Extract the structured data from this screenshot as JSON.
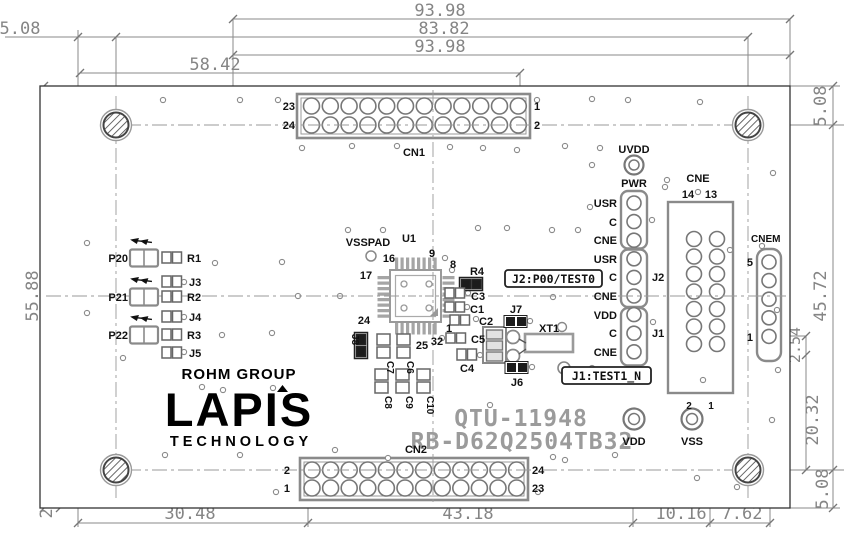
{
  "drawing": {
    "logo": {
      "rohm_group": "ROHM GROUP",
      "lapis": "LAPIS",
      "technology": "TECHNOLOGY"
    },
    "codes": {
      "line1": "QTU-11948",
      "line2": "RB-D62Q2504TB32"
    },
    "dims": {
      "top_outer": "93.98",
      "top_holes": "83.82",
      "top_inner": "93.98",
      "cn1_offset": "58.42",
      "hole_offset_left": "5.08",
      "board_height": "55.88",
      "pin_span_v": "50.8",
      "bottom_left_gap": "2.54",
      "b1": "30.48",
      "b2": "43.18",
      "b3": "10.16",
      "b4": "7.62",
      "r_top": "5.08",
      "r_span": "45.72",
      "r_pitch": "2.54",
      "r_mid": "20.32",
      "r_bot": "5.08"
    },
    "cn1": {
      "label": "CN1",
      "tl": "23",
      "bl": "24",
      "tr": "1",
      "br": "2"
    },
    "cn2": {
      "label": "CN2",
      "tl": "2",
      "bl": "1",
      "tr": "24",
      "br": "23"
    },
    "cne": {
      "label": "CNE",
      "t1": "14",
      "t2": "13",
      "b1": "2",
      "b2": "1"
    },
    "cnem": {
      "label": "CNEM",
      "top": "5",
      "bottom": "1"
    },
    "header": {
      "uvdd": "UVDD",
      "pwr": "PWR",
      "rows": [
        "USR",
        "C",
        "CNE",
        "USR",
        "C",
        "CNE",
        "VDD",
        "C",
        "CNE"
      ],
      "j2": "J2",
      "j1": "J1"
    },
    "notes": {
      "j2": "J2:P00/TEST0",
      "j1": "J1:TEST1_N"
    },
    "pads": {
      "vdd": "VDD",
      "vss": "VSS"
    },
    "u1": {
      "ref": "U1",
      "vsspad": "VSSPAD",
      "p16": "16",
      "p9": "9",
      "p17": "17",
      "p8": "8",
      "p24": "24",
      "p1": "1",
      "p25": "25",
      "p32": "32"
    },
    "parts": {
      "p20": "P20",
      "p21": "P21",
      "p22": "P22",
      "r1": "R1",
      "r2": "R2",
      "r3": "R3",
      "r4": "R4",
      "j3": "J3",
      "j4": "J4",
      "j5": "J5",
      "j6": "J6",
      "j7": "J7",
      "j8": "J8",
      "c1": "C1",
      "c2": "C2",
      "c3": "C3",
      "c4": "C4",
      "c5": "C5",
      "c6": "C6",
      "c7": "C7",
      "c8": "C8",
      "c9": "C9",
      "c10": "C10",
      "xt1": "XT1"
    }
  }
}
